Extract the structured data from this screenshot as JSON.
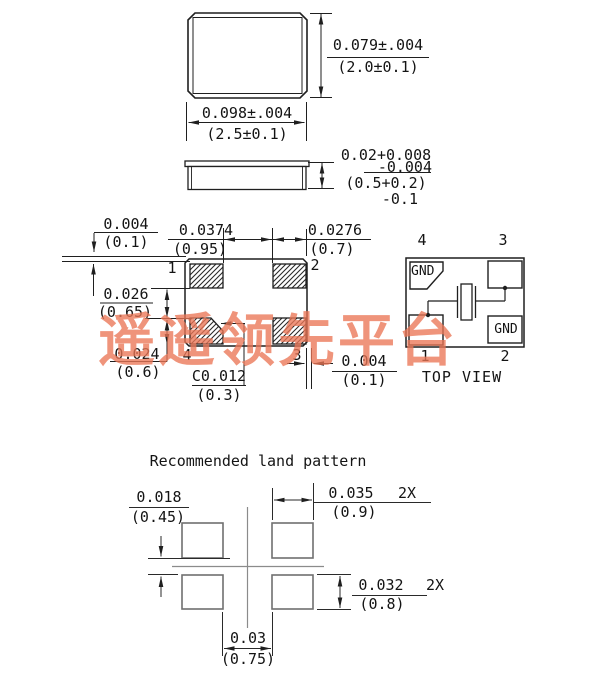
{
  "colors": {
    "line": "#1f1f1f",
    "land_line": "#707070",
    "watermark": "#eb7656"
  },
  "watermark": {
    "text": "遥遥领先平台"
  },
  "outline_view": {
    "height_spec_in": "0.079±.004",
    "height_spec_mm": "(2.0±0.1)",
    "width_spec_in": "0.098±.004",
    "width_spec_mm": "(2.5±0.1)"
  },
  "side_view": {
    "thickness_in": "0.02+0.008",
    "thickness_in_tol": "-0.004",
    "thickness_mm": "(0.5+0.2)",
    "thickness_mm_tol": "-0.1"
  },
  "bottom_view": {
    "pin1": "1",
    "pin2": "2",
    "pin3": "3",
    "pin4": "4",
    "top_edge_gap_in": "0.004",
    "top_edge_gap_mm": "(0.1)",
    "pad_pitch_in": "0.0374",
    "pad_pitch_mm": "(0.95)",
    "pad_width_in": "0.0276",
    "pad_width_mm": "(0.7)",
    "pad_gap_in": "0.026",
    "pad_gap_mm": "(0.65)",
    "pad_height_in": "0.024",
    "pad_height_mm": "(0.6)",
    "chamfer_in": "C0.012",
    "chamfer_mm": "(0.3)",
    "right_edge_gap_in": "0.004",
    "right_edge_gap_mm": "(0.1)"
  },
  "top_view": {
    "pin1": "1",
    "pin2": "2",
    "pin3": "3",
    "pin4": "4",
    "gnd": "GND",
    "caption": "TOP VIEW"
  },
  "land_pattern": {
    "title": "Recommended land pattern",
    "row_gap_in": "0.018",
    "row_gap_mm": "(0.45)",
    "pad_width_in": "0.035",
    "pad_width_qty": "2X",
    "pad_width_mm": "(0.9)",
    "pad_height_in": "0.032",
    "pad_height_qty": "2X",
    "pad_height_mm": "(0.8)",
    "col_gap_in": "0.03",
    "col_gap_mm": "(0.75)"
  }
}
